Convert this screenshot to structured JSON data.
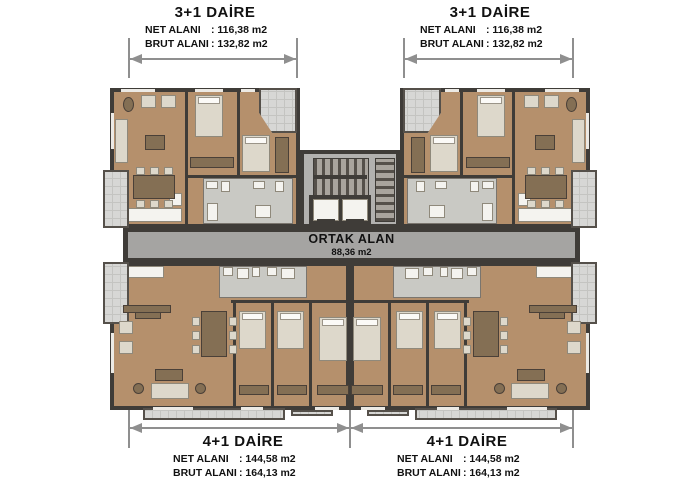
{
  "labels": {
    "top_left": {
      "title": "3+1 DAİRE",
      "net_label": "NET ALANI",
      "net_value": ": 116,38 m2",
      "brut_label": "BRUT ALANI",
      "brut_value": ": 132,82 m2"
    },
    "top_right": {
      "title": "3+1 DAİRE",
      "net_label": "NET ALANI",
      "net_value": ": 116,38 m2",
      "brut_label": "BRUT ALANI",
      "brut_value": ": 132,82 m2"
    },
    "bottom_left": {
      "title": "4+1 DAİRE",
      "net_label": "NET ALANI",
      "net_value": ": 144,58 m2",
      "brut_label": "BRUT ALANI",
      "brut_value": ": 164,13 m2"
    },
    "bottom_right": {
      "title": "4+1 DAİRE",
      "net_label": "NET ALANI",
      "net_value": ": 144,58 m2",
      "brut_label": "BRUT ALANI",
      "brut_value": ": 164,13 m2"
    }
  },
  "common_area": {
    "title": "ORTAK ALAN",
    "area": "88,36 m2"
  },
  "colors": {
    "floor_tan": "#b5906c",
    "wall_dark": "#3f3c38",
    "corridor_gray": "#a5a4a2",
    "core_gray": "#b2b1af",
    "balcony_gray": "#d7d7d5",
    "bath_gray": "#c9c9c4",
    "furniture_brown": "#846f54",
    "upholstery": "#ddd8cb",
    "window_light": "#eceae5"
  }
}
